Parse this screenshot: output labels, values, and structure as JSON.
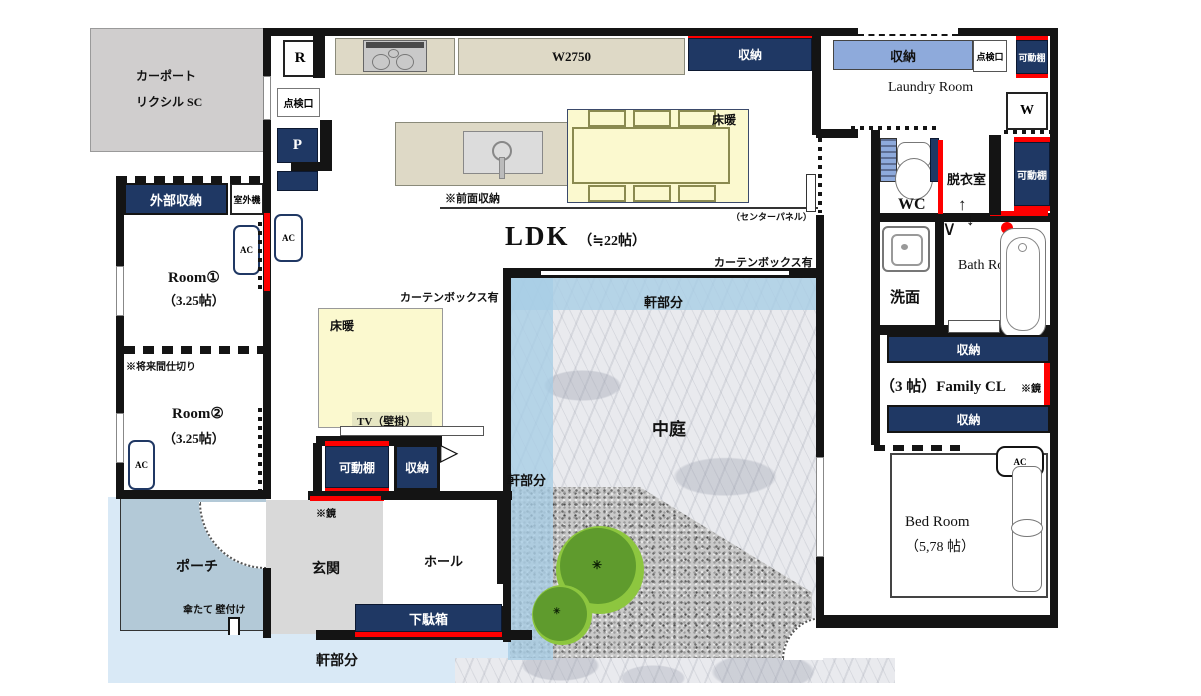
{
  "title": "間取り図",
  "carport": {
    "line1": "カーポート",
    "line2": "リクシル SC"
  },
  "kitchen": {
    "r": "R",
    "tenkenko": "点検口",
    "p": "P",
    "w2750": "W2750",
    "shuno": "収納",
    "zenmen": "※前面収納",
    "center_panel": "（センターパネル）",
    "yukadan_dining": "床暖"
  },
  "ldk": {
    "title": "LDK",
    "size": "（≒22帖）",
    "curtain_left": "カーテンボックス有",
    "curtain_right": "カーテンボックス有",
    "yukadan_living": "床暖",
    "tv": "TV（壁掛）",
    "kadodana": "可動棚",
    "shuno": "収納",
    "ac": "AC"
  },
  "left_wing": {
    "gaibu_shuno": "外部収納",
    "shitsugaiki": "室外機",
    "room1": "Room①",
    "room1_size": "（3.25帖）",
    "room2": "Room②",
    "room2_size": "（3.25帖）",
    "mirai_majikiri": "※将来間仕切り",
    "ac1": "AC",
    "ac2": "AC"
  },
  "entrance": {
    "porch": "ポーチ",
    "genkan": "玄関",
    "hall": "ホール",
    "getabako": "下駄箱",
    "kagami": "※鏡",
    "kasatate": "傘たて 壁付け"
  },
  "courtyard": {
    "nakaniwa": "中庭",
    "noki_top": "軒部分",
    "noki_left": "軒部分",
    "noki_bottom": "軒部分"
  },
  "right_wing": {
    "laundry_shuno": "収納",
    "tenkenko": "点検口",
    "kadodana_top": "可動棚",
    "laundry": "Laundry Room",
    "w": "W",
    "kadodana_mid": "可動棚",
    "wc": "WC",
    "datsuishitsu": "脱衣室",
    "senmen": "洗面",
    "bath": "Bath Room",
    "shuno_top": "収納",
    "family_cl": "（3 帖）Family CL",
    "kagami": "※鏡",
    "shuno_bottom": "収納",
    "bedroom": "Bed Room",
    "bedroom_size": "（5,78 帖）",
    "ac": "AC"
  },
  "icons": {
    "door_triangle": "▷",
    "arrow_up": "↑",
    "arrow_down": "↓",
    "door_v": "∨",
    "tree_mark": "✳"
  },
  "colors": {
    "navy": "#1f3864",
    "light_blue": "#8eaadb",
    "red": "#fe0000",
    "eave_blue": "#a6cde5",
    "pale_blue_band": "#d9e9f6",
    "porch_blue": "#b3c9d7",
    "genkan_gray": "#d9d9d9",
    "carport_gray": "#d0cece",
    "counter_beige": "#ded9c6",
    "yukadan_yellow": "#fbf9cf",
    "tree_light": "#8dc63f",
    "tree_dark": "#5f9b2d",
    "wall_black": "#141414"
  }
}
